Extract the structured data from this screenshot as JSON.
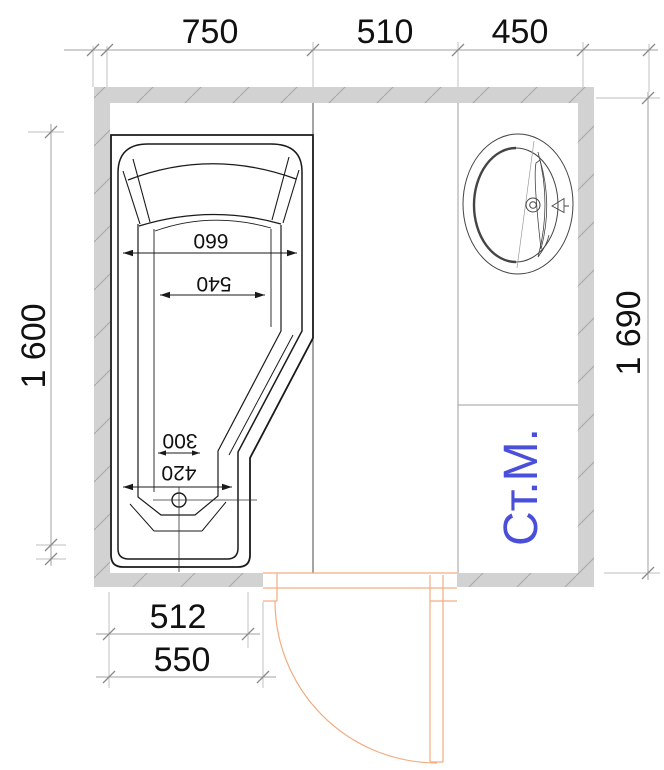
{
  "plan": {
    "title": "bathroom-floor-plan",
    "top_dims": [
      "750",
      "510",
      "450"
    ],
    "left_dim": "1 600",
    "right_dim": "1 690",
    "bottom_dims": [
      "512",
      "550"
    ],
    "bathtub": {
      "head_width": "660",
      "head_inner_width": "540",
      "foot_inner_width": "300",
      "foot_width": "420"
    },
    "washing_machine_label": "Ст.М.",
    "colors": {
      "wall_fill": "#d2d2d2",
      "wall_hatch": "#a8a8a8",
      "door": "#f2ad80",
      "washing_machine_text": "#4a4fd9",
      "drawing_line": "#1a1a1a",
      "dimension_line": "#9a9a9a"
    }
  }
}
